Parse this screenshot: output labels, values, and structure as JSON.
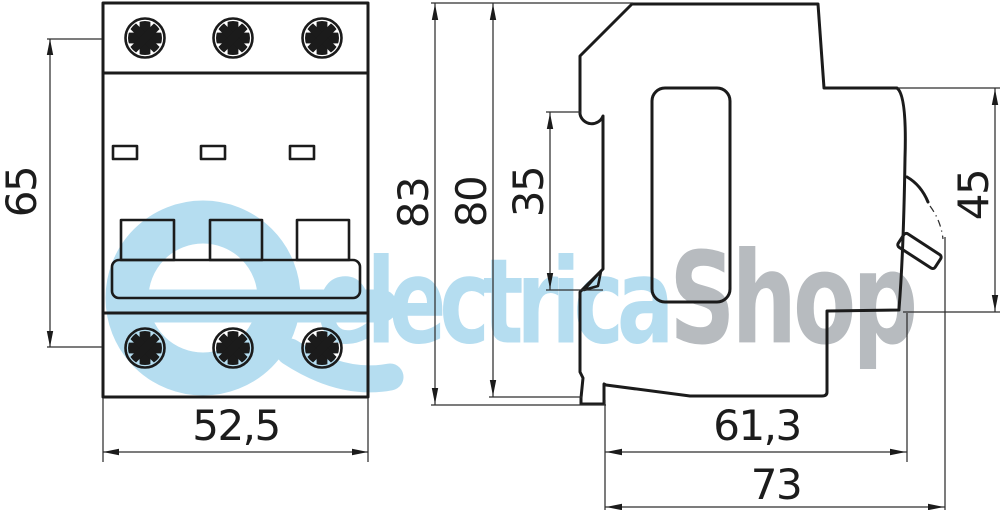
{
  "watermark": {
    "blue_text": "electrica",
    "gray_text": "Shop",
    "blue_color": "#b5ddf0",
    "gray_color": "#b7bbbf"
  },
  "front_view": {
    "height": "65",
    "width": "52,5"
  },
  "side_view": {
    "total_height": "83",
    "housing_height": "80",
    "din_rail_section": "35",
    "handle_section": "45",
    "body_depth": "61,3",
    "total_depth": "73"
  },
  "colors": {
    "line": "#1b1b1b",
    "background": "#ffffff"
  }
}
